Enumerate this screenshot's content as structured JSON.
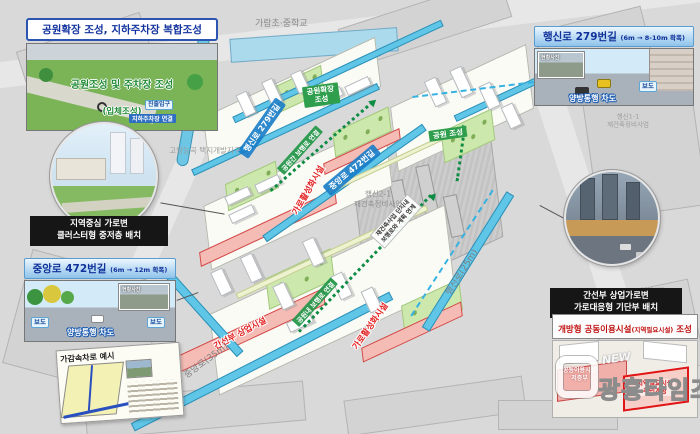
{
  "map": {
    "school": "가람초·중학교",
    "district_left": "고양능곡 택지개발지구",
    "district_right": "고양행신2\n공공주택지구",
    "zone_center": "행신2-1\n재건축정비사업",
    "zone_right": "행신1-1\n재건축정비사업",
    "road_jungang": "중앙로(35m)",
    "road_haengsin": "행신로(25m)",
    "band_haengsin": "행신로 279번길",
    "band_jungang": "중앙로 472번길",
    "park_expand": "공원확장\n조성",
    "park_new": "공원 조성",
    "walk_link_upper": "공원간 보행로 연결",
    "walk_link_lower": "공원내 보행로 연결",
    "rebuild_link": "재건축사업 단지내\n보행로와 계획 연계",
    "street_vitality": "가로활성화시설",
    "arterial_commercial": "간선부 상업시설"
  },
  "callout_park": {
    "title": "공원확장 조성, 지하주차장 복합조성",
    "overlay_line1": "공원조성 및 주차장 조성",
    "overlay_line2": "(입체조성)",
    "tag_entry": "진출입구",
    "tag_parking": "지하주차장 연결"
  },
  "callout_cluster": {
    "label": "지역중심 가로변\n클러스터형 중저층 배치"
  },
  "callout_jungang": {
    "title": "중앙로 472번길",
    "title_sub": "(6m → 12m 확폭)",
    "sidewalk_left": "보도",
    "sidewalk_right": "보도",
    "roadway": "양방통행 차도",
    "inset_caption": "현황사진",
    "sub_title": "가감속차로 예시"
  },
  "callout_haengsin": {
    "title": "행신로 279번길",
    "title_sub": "(6m → 8-10m 확폭)",
    "sidewalk": "보도",
    "roadway": "양방통행 차도",
    "inset_caption": "현황사진"
  },
  "callout_podium": {
    "label": "간선부 상업가로변\n가로대응형 기단부 배치"
  },
  "callout_community": {
    "title_main": "개방형 공동이용시설",
    "title_paren": "(지역필요시설)",
    "title_tail": " 조성",
    "label_left": "공동이용시설\n저층부",
    "label_right": "지역필요시설\n주민개방"
  },
  "watermark": {
    "new": "NEW",
    "name": "광흥타임즈"
  },
  "colors": {
    "header_blue_text": "#10329a",
    "road_cyan": "#5fc6e8",
    "park_green": "#cde8ac",
    "podium_pink": "#f4bcb4",
    "vitality_red": "#e32222",
    "walkway_green": "#0e8c44",
    "community_red": "#e01515"
  }
}
